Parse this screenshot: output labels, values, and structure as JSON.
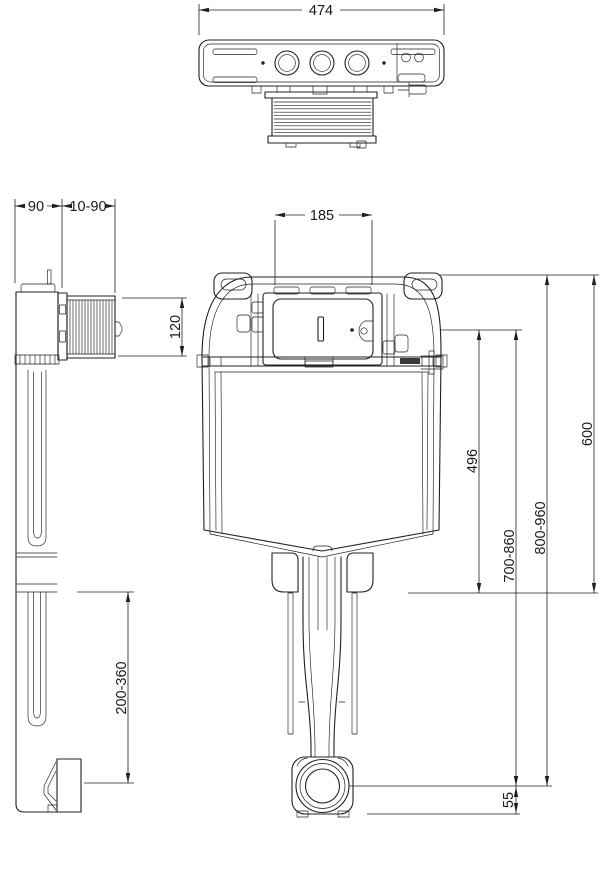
{
  "drawing": {
    "background": "#ffffff",
    "line_color": "#202020"
  },
  "top_view": {
    "dim_overall_width": "474"
  },
  "side_view": {
    "dim_body_depth": "90",
    "dim_wall_gap": "10-90",
    "dim_shaft_height": "120",
    "dim_outlet_drop": "200-360"
  },
  "front_view": {
    "dim_plate_width": "185",
    "dim_upper_height": "496",
    "dim_height_600": "600",
    "dim_install_range_low": "700-860",
    "dim_install_range_high": "800-960",
    "dim_outlet_center_height": "55"
  }
}
